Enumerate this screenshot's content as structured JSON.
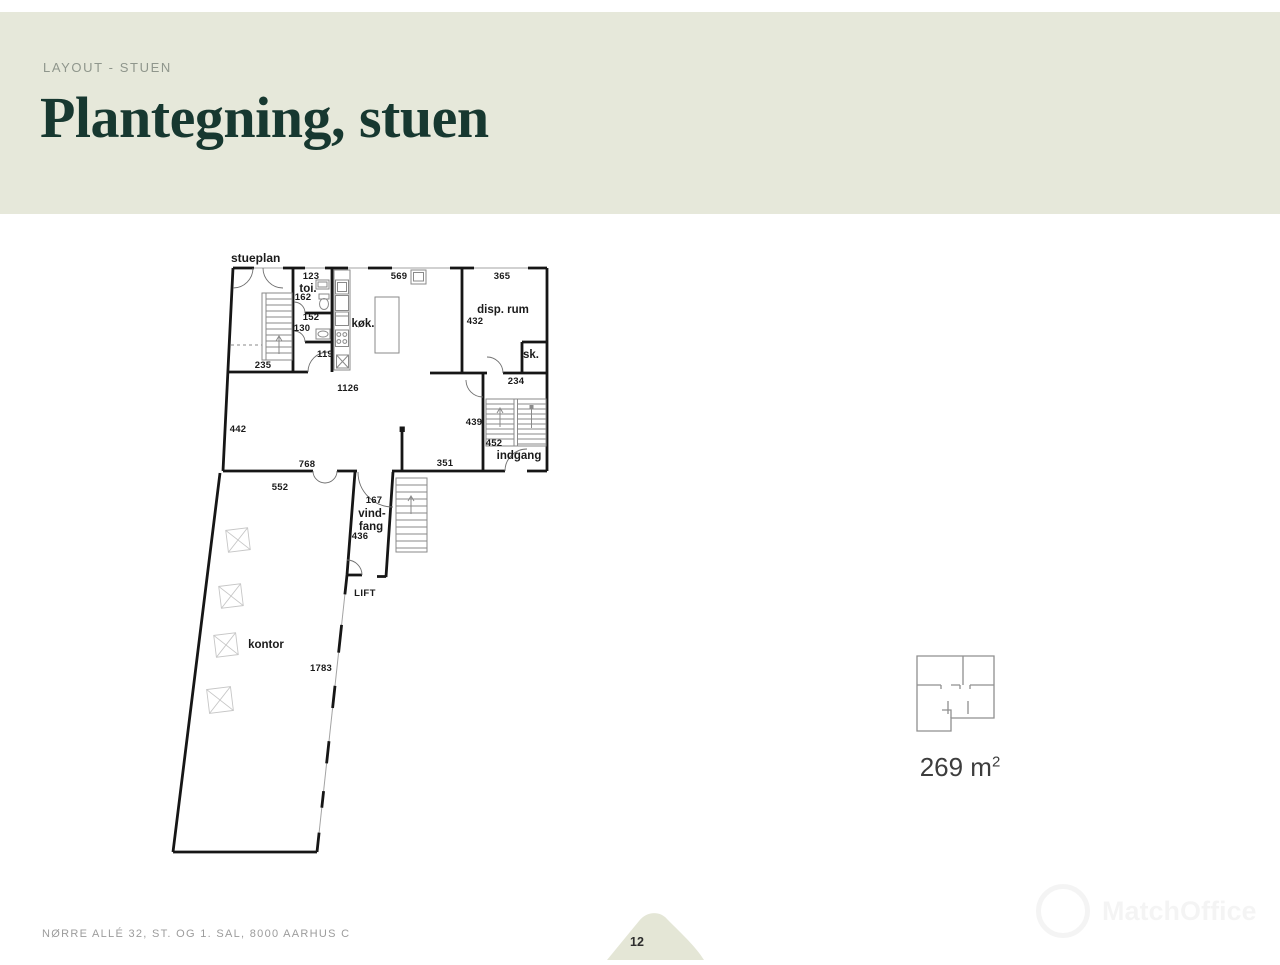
{
  "header": {
    "eyebrow": "LAYOUT - STUEN",
    "title": "Plantegning, stuen"
  },
  "plan": {
    "title": "stueplan",
    "labels": {
      "m123": "123",
      "toi": "toi.",
      "m162": "162",
      "m152": "152",
      "m130": "130",
      "m119": "119",
      "m235": "235",
      "kok": "køk.",
      "m569": "569",
      "m365": "365",
      "disp_rum": "disp. rum",
      "m432": "432",
      "sk": "sk.",
      "m234": "234",
      "m1126": "1126",
      "m442": "442",
      "m768": "768",
      "m351": "351",
      "m439": "439",
      "m452": "452",
      "indgang": "indgang",
      "m552": "552",
      "m167": "167",
      "vind": "vind-",
      "fang": "fang",
      "m436": "436",
      "lift": "LIFT",
      "kontor": "kontor",
      "m1783": "1783"
    }
  },
  "area": {
    "value": "269 m",
    "sup": "2"
  },
  "footer": {
    "address": "NØRRE ALLÉ 32, ST. OG 1. SAL, 8000 AARHUS C",
    "page": "12"
  },
  "watermark": {
    "text": "MatchOffice"
  },
  "colors": {
    "band": "#e6e8da",
    "title": "#173830",
    "leaf": "#e4e6d6",
    "plan_line": "#161616"
  }
}
